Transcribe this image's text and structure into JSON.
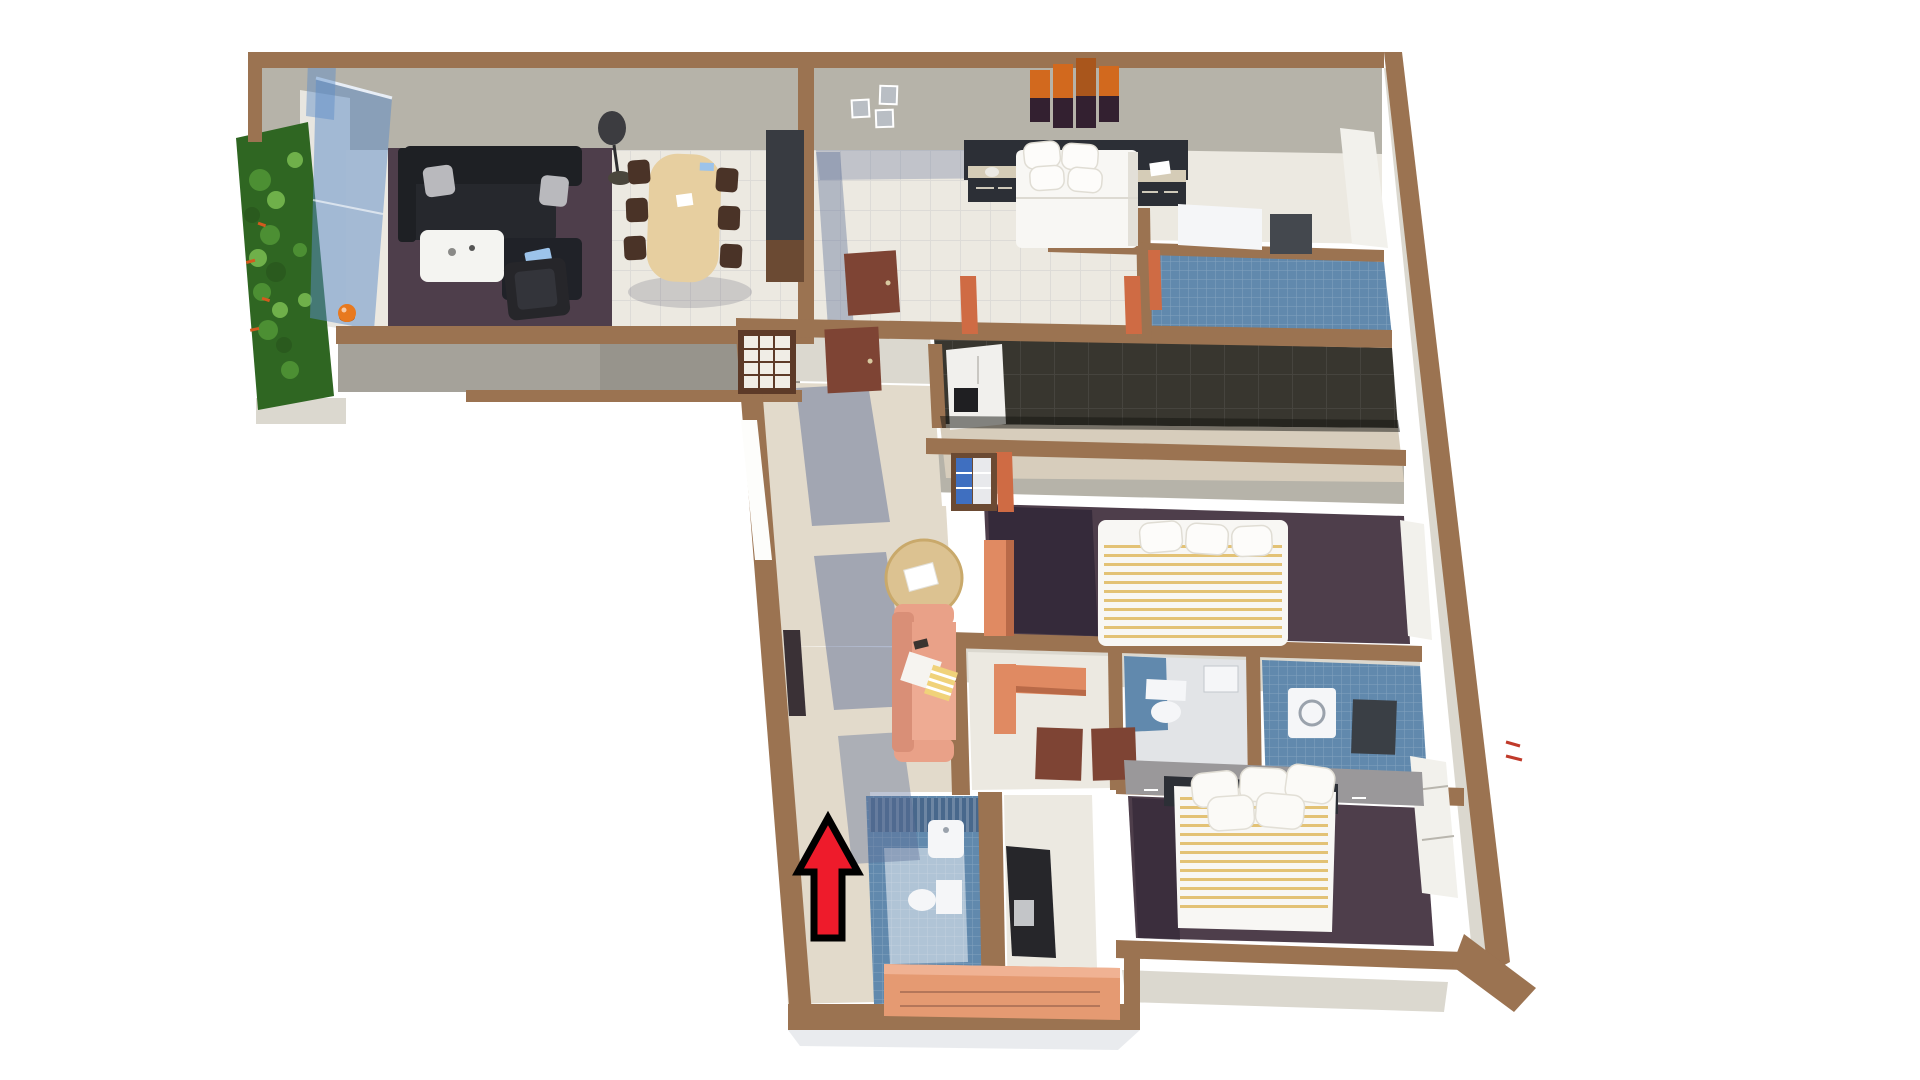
{
  "meta": {
    "description": "3D rendered dollhouse floor plan of a three-bedroom apartment viewed from above, on a white background, with a red arrow marking the entrance",
    "background": "#ffffff"
  },
  "colors": {
    "wall_brown": "#9b7351",
    "wall_brown_dark": "#845e42",
    "wall_face": "#b6b3a9",
    "wall_face_light": "#dbd8cf",
    "parapet_gray": "#a5a29a",
    "floor_cream": "#ece9e1",
    "floor_beige": "#e2dacb",
    "shadow_blue": "#5d6d96",
    "carpet_purple": "#4e3e4b",
    "carpet_shadow": "#2e2434",
    "kitchen_dark": "#38362f",
    "kitchen_beige": "#d7cdbc",
    "bath_blue": "#6189ad",
    "bath_blue_dark": "#48688c",
    "bath_pale": "#e2e4e7",
    "glass_blue": "#5b8cc8",
    "garden_dark": "#2f6622",
    "garden_leaf": "#4c8f33",
    "garden_leaf_light": "#6fb04a",
    "flower_orange": "#d45a1e",
    "sofa_black": "#1e2024",
    "sofa_black_seat": "#26282d",
    "cushion_gray": "#b9b9bd",
    "book_blue": "#9cc3ea",
    "table_white": "#f4f4f1",
    "armchair_black": "#26262a",
    "lamp_dark": "#3c3c40",
    "wood_light": "#e7cfa0",
    "wood_round": "#dcc291",
    "chair_brown": "#4a3327",
    "cabinet_dark": "#383b41",
    "cabinet_wood": "#6b4a33",
    "bed_white": "#f8f7f4",
    "headboard_dark": "#2c2f36",
    "nightstand_beige": "#d5ccb7",
    "art_orange": "#d2691e",
    "art_dark": "#332030",
    "frame_gray": "#b9bec4",
    "door_brown": "#7e4434",
    "door_frame": "#cf6b44",
    "fridge_white": "#f1f0ed",
    "fridge_panel": "#1f1f22",
    "shelf_blue": "#3f6fc0",
    "shelf_white": "#e8e9ec",
    "desk_salmon": "#e08a62",
    "desk_salmon_dark": "#b96a48",
    "sofa_salmon": "#e9a188",
    "sofa_salmon_light": "#eeab93",
    "console_salmon": "#e59a72",
    "stripe_yellow": "#dfb95f",
    "headboard_gray": "#9a989a",
    "tv_dark": "#26262a",
    "fixture_white": "#f5f6f8",
    "window_white": "#f2f1ec",
    "ball_orange": "#e8791e",
    "shoji_brown": "#5d3a28",
    "shoji_paper": "#f0ede6",
    "arrow_red": "#ee1b2b",
    "arrow_outline": "#000000",
    "red_mark": "#c03a2a"
  },
  "rooms": [
    {
      "id": "balcony-garden",
      "label": "Balcony garden"
    },
    {
      "id": "living-room",
      "label": "Living room"
    },
    {
      "id": "dining-area",
      "label": "Dining area"
    },
    {
      "id": "bedroom-top",
      "label": "Top bedroom"
    },
    {
      "id": "ensuite-bathroom",
      "label": "En-suite bathroom"
    },
    {
      "id": "kitchen",
      "label": "Kitchen"
    },
    {
      "id": "hallway",
      "label": "Hallway"
    },
    {
      "id": "middle-bedroom",
      "label": "Middle bedroom"
    },
    {
      "id": "study",
      "label": "Study"
    },
    {
      "id": "toilet-bathroom",
      "label": "Toilet bathroom"
    },
    {
      "id": "laundry-bathroom",
      "label": "Laundry bathroom"
    },
    {
      "id": "guest-bathroom",
      "label": "Guest bathroom at entry"
    },
    {
      "id": "bottom-bedroom",
      "label": "Bottom bedroom"
    },
    {
      "id": "entry",
      "label": "Entry"
    }
  ],
  "furniture": [
    "black-l-sofa",
    "gray-cushions",
    "blue-book",
    "white-coffee-table",
    "black-armchair",
    "floor-lamp",
    "dining-table",
    "dining-chairs",
    "sideboard-cabinet",
    "double-bed-white",
    "nightstands",
    "sunset-wall-art",
    "photo-frames",
    "leaning-door",
    "vanity",
    "refrigerator",
    "bookshelf",
    "shoji-screen",
    "round-side-table",
    "salmon-sofa",
    "tv-panel",
    "entry-console",
    "striped-bed-middle",
    "desk-middle-bedroom",
    "study-desk",
    "toilet",
    "bathroom-sink",
    "washing-machine",
    "shower-blue-tiles",
    "striped-bed-bottom",
    "headboard-unit",
    "balcony-plants",
    "glass-balustrade",
    "orange-ball"
  ],
  "annotations": {
    "entrance_arrow": {
      "direction": "up",
      "fill": "#ee1b2b",
      "outline": "#000000"
    }
  }
}
